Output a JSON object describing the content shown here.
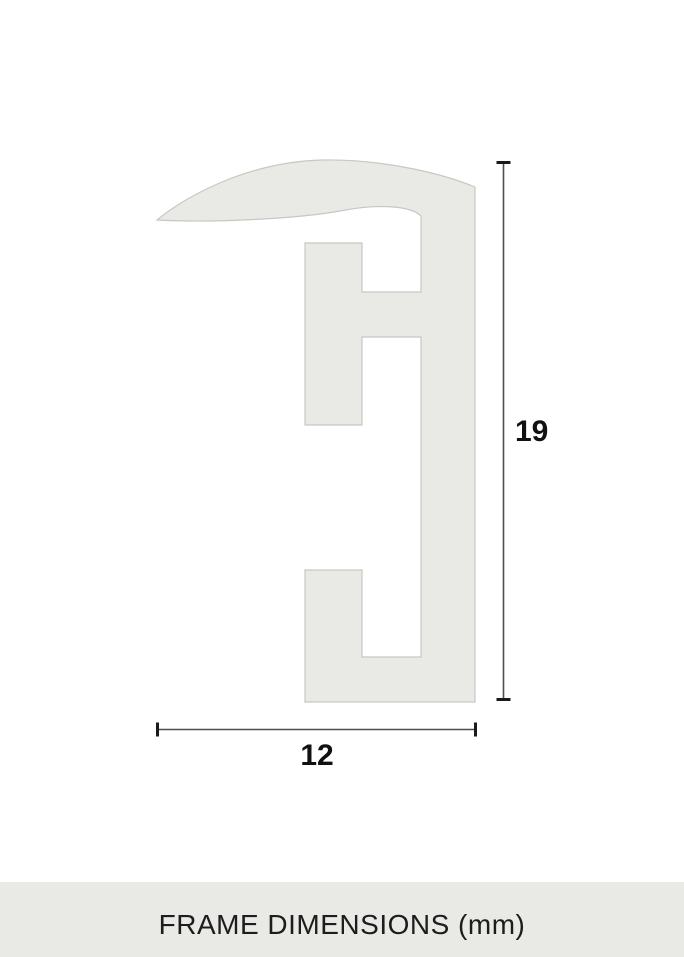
{
  "diagram": {
    "profile_path": "M 157,220 C 186,196 248,162 322,160 C 376,159 436,171 475,187 L 475,702 L 305,702 L 305,570 L 362,570 L 362,657 L 421,657 L 421,337 L 362,337 L 362,425 L 305,425 L 305,243 L 362,243 L 362,292 L 421,292 L 421,216 C 410,205 375,204 340,211 C 295,219 210,223 157,220 Z",
    "height_dimension": {
      "value": "19"
    },
    "width_dimension": {
      "value": "12"
    },
    "unit": "mm"
  },
  "footer": {
    "caption": "FRAME DIMENSIONS (mm)"
  },
  "colors": {
    "background": "#ffffff",
    "profile_fill": "#e9e9e5",
    "profile_stroke": "#c7c7c3",
    "dimension_line": "#4f4f4f",
    "dimension_tick": "#1a1a1a",
    "dimension_text": "#111111",
    "footer_background": "#e9e9e6",
    "footer_text": "#1d1d1d"
  }
}
